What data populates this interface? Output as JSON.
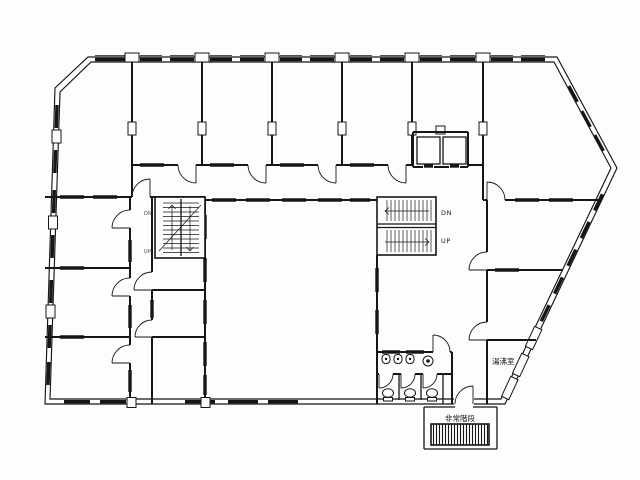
{
  "plan": {
    "type": "architectural-floor-plan",
    "style": "scanned black-line office building floor plan, irregular pentagon outline with beveled top-left corner and pointed right corner"
  },
  "labels": {
    "right_stair_dn": "DN",
    "right_stair_up": "UP",
    "left_stair_dn": "DN",
    "left_stair_up": "UP",
    "kitchenette": "湯沸室",
    "emergency_stairs": "非常階段"
  },
  "colors": {
    "ink": "#161616",
    "paper": "#fdfdfc"
  }
}
